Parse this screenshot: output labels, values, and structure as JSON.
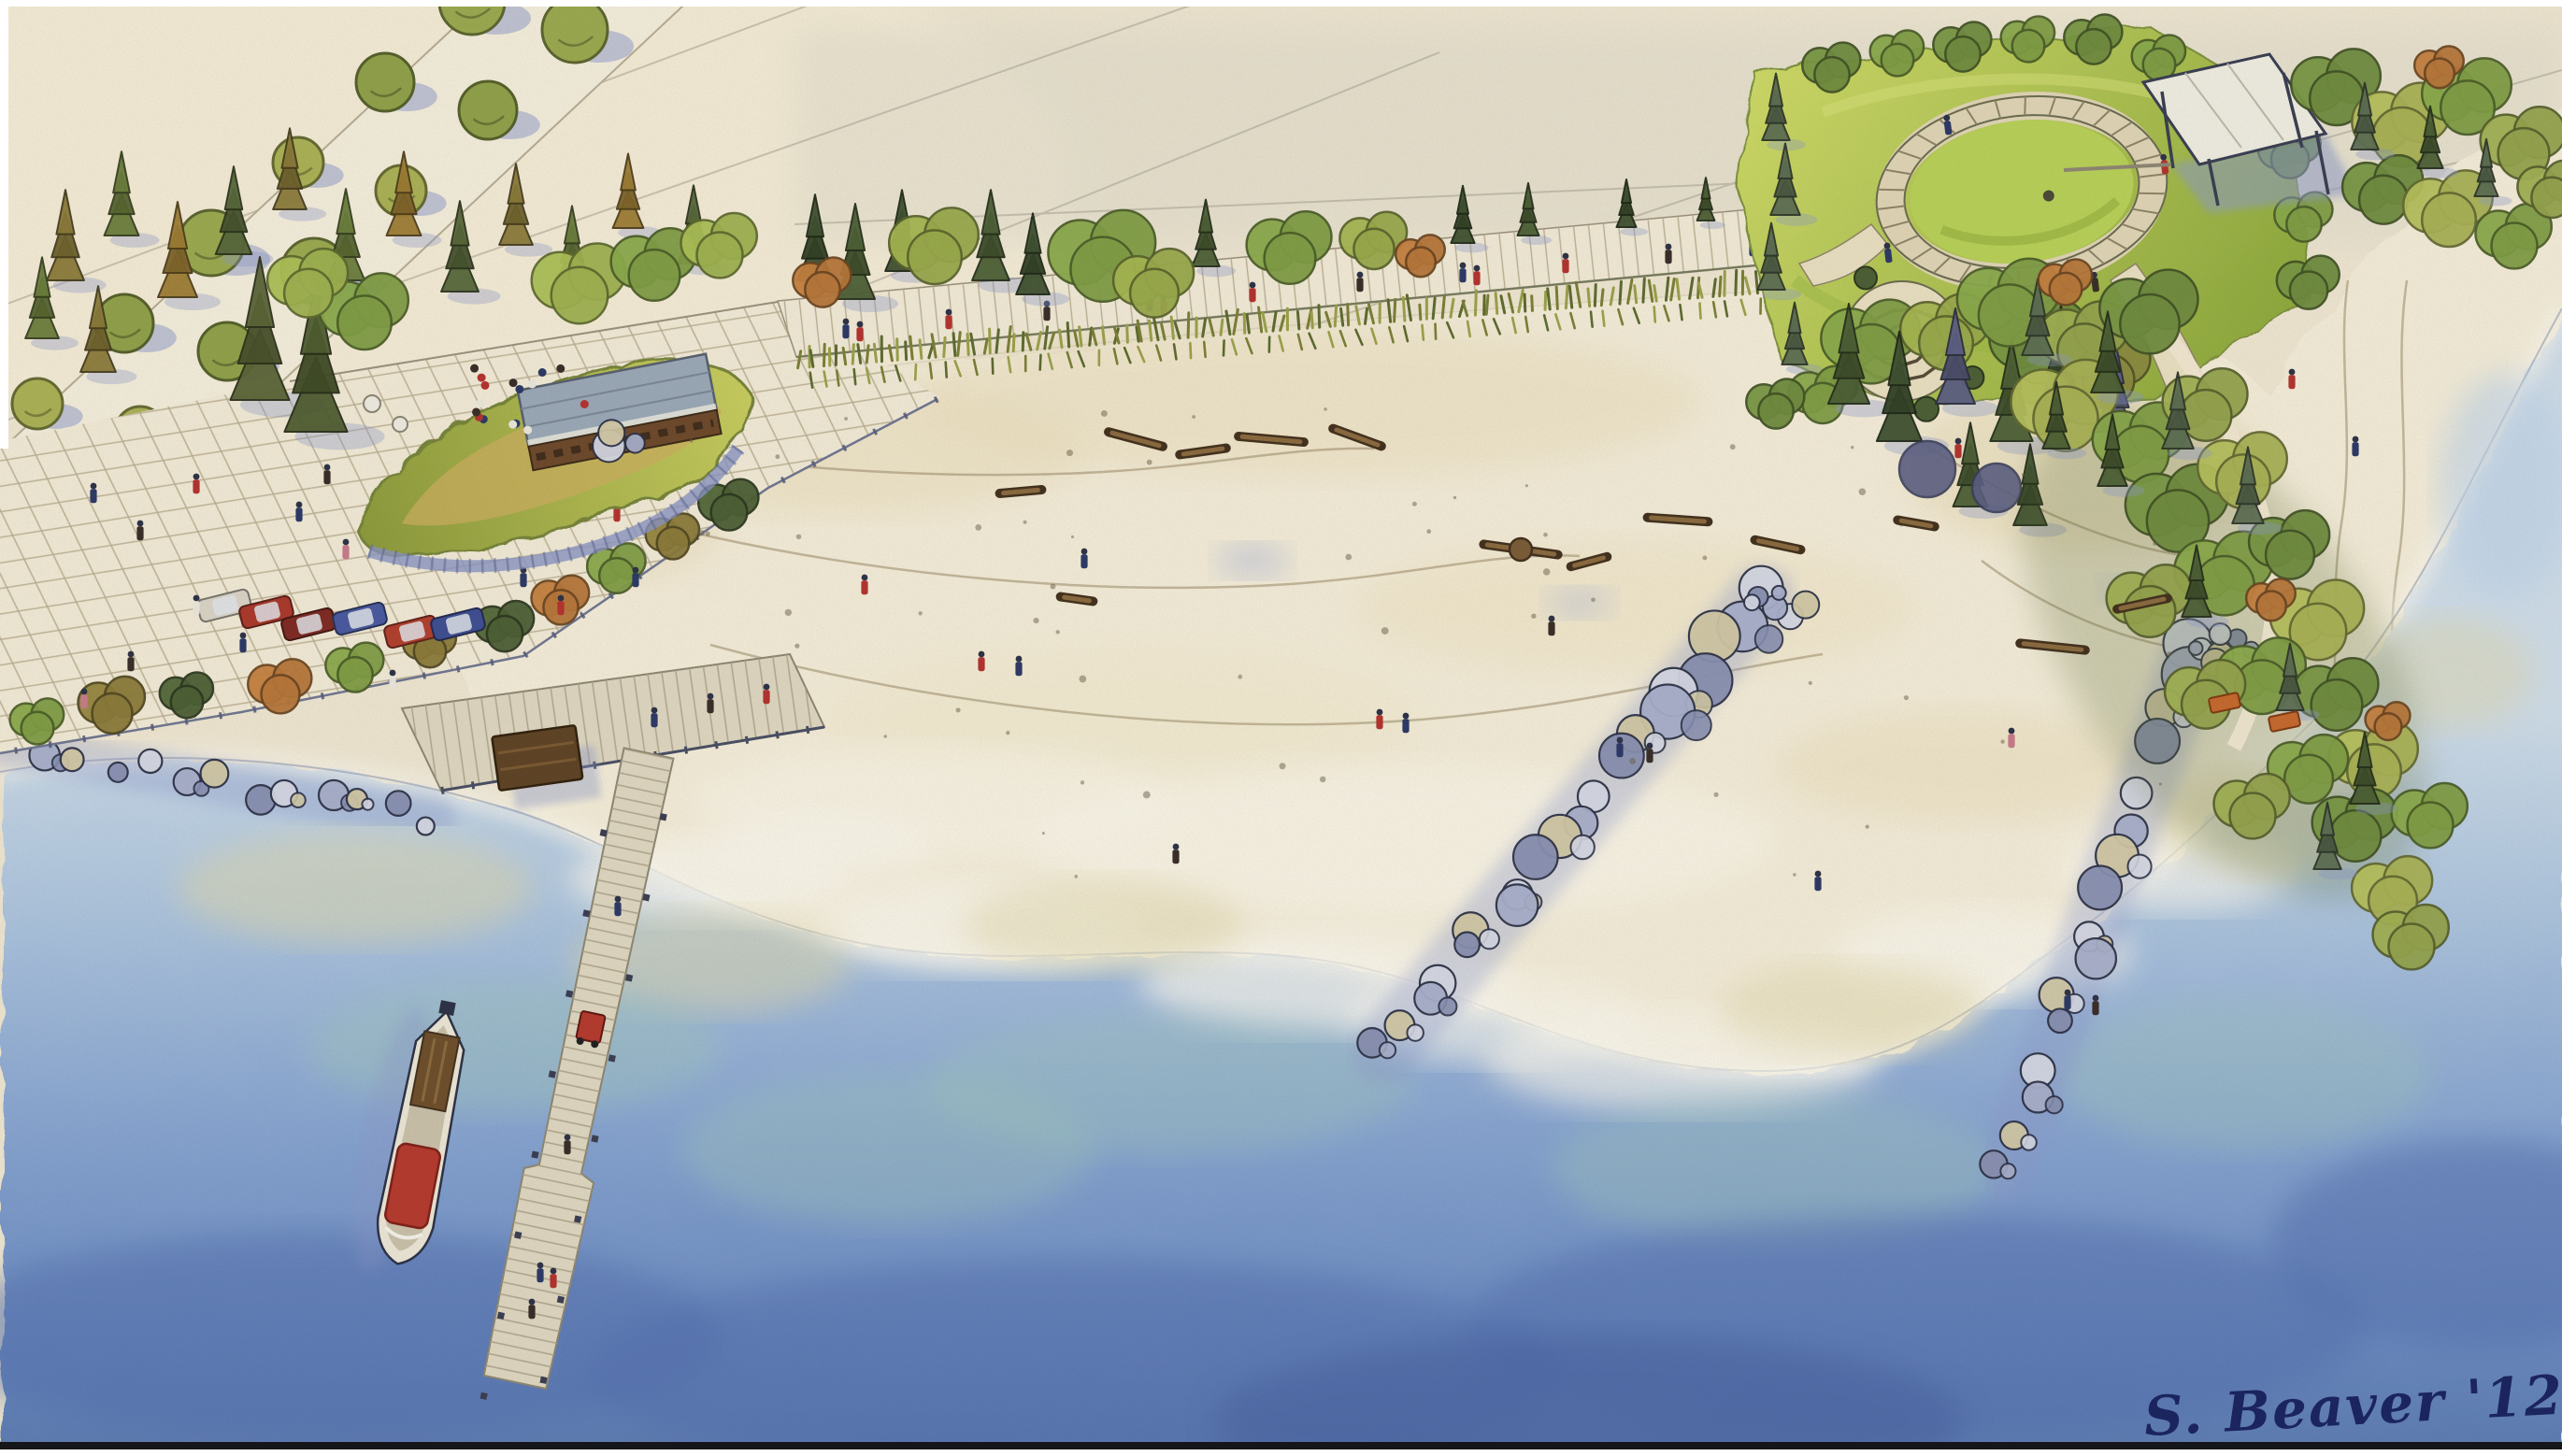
{
  "artwork": {
    "signature": "S. Beaver '12"
  },
  "palette": {
    "paper": "#ece4cf",
    "sand": "#f1ead6",
    "sand_wash": "#e8dcba",
    "plaza": "#efe8d4",
    "grid_line": "#b7ab8e",
    "deck": "#ddd5bf",
    "wood": "#6e4f2c",
    "wood_dark": "#43321e",
    "roof_grey": "#9aa7b5",
    "lawn": "#b6cd55",
    "lawn_dark": "#8ea93e",
    "foliage": "#7f9c45",
    "foliage_dark": "#4c5f35",
    "foliage_olive": "#8a7a3a",
    "foliage_blue": "#5d6e53",
    "rust": "#b5763a",
    "water_edge": "#cddbe7",
    "water_mid": "#86a3cf",
    "water_deep": "#5e7cb2",
    "water_teal": "#9fc3bb",
    "shallow_sand": "#ded5a9",
    "foam": "#f7f4ea",
    "shadow_blue": "#8c98c8",
    "rock_light": "#d3d6e2",
    "rock_mid": "#a7aec9",
    "rock_dark": "#888fb0",
    "rock_tan": "#cfc6a4",
    "boat_red": "#b33b2e",
    "contour": "#a29272",
    "ink": "#2e3347",
    "ink_soft": "#4a4f63",
    "signature_ink": "#1b2560",
    "people_navy": "#2e3a66",
    "people_red": "#b23430",
    "people_dark": "#3a2f28",
    "people_pink": "#c77b8a"
  }
}
